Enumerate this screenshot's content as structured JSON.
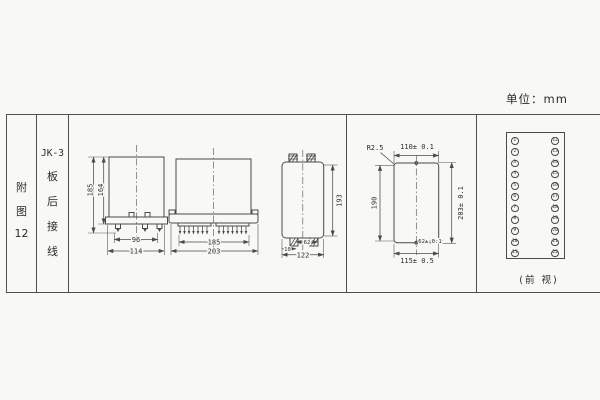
{
  "unit_label": "单位：mm",
  "sidebar": {
    "figure": [
      "附",
      "图",
      "12"
    ],
    "series": [
      "JK-3",
      "板",
      "后",
      "接",
      "线"
    ]
  },
  "side_view": {
    "height_outer": "185",
    "height_inner": "164",
    "width_inner": "96",
    "width_outer": "114"
  },
  "front_view": {
    "width_inner": "185",
    "width_outer": "203"
  },
  "profile_view": {
    "height": "193",
    "edge_offset": "10",
    "stud_span": "62",
    "width": "122"
  },
  "cutout_view": {
    "corner_radius": "R2.5",
    "width_top": "110± 0.1",
    "height_left": "190",
    "height_right": "203± 0.1",
    "hole_span": "62± 0.1",
    "width_bottom": "115± 0.5"
  },
  "terminal": {
    "pins": [
      "1",
      "2",
      "3",
      "4",
      "5",
      "6",
      "7",
      "8",
      "9",
      "10",
      "11",
      "12",
      "13",
      "14",
      "15",
      "16",
      "17",
      "18",
      "19",
      "20",
      "21",
      "22"
    ],
    "caption": "(前 视)"
  }
}
